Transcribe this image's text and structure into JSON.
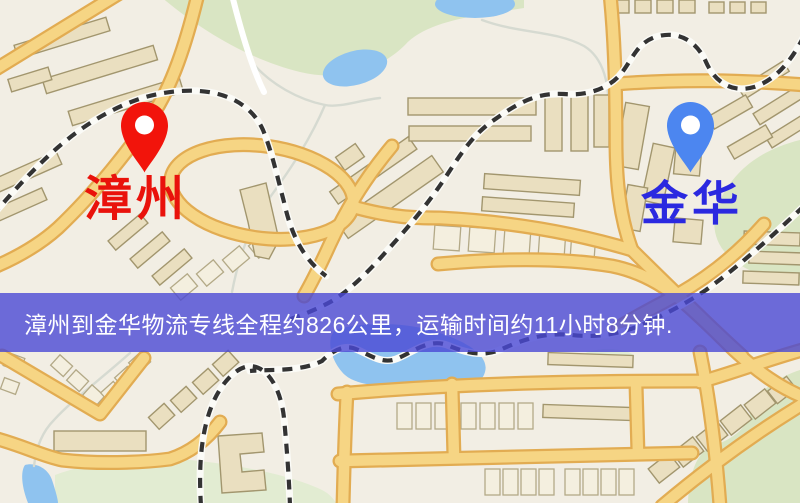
{
  "origin": {
    "name": "漳州",
    "pin_color": "#f2140b",
    "label_color": "#e9120b"
  },
  "destination": {
    "name": "金华",
    "pin_color": "#4c86f0",
    "label_color": "#2b29e0"
  },
  "banner": {
    "text": "漳州到金华物流专线全程约826公里，运输时间约11小时8分钟.",
    "background_color": "#4a49d5",
    "text_color": "#ffffff"
  },
  "route": {
    "origin": "漳州",
    "destination": "金华",
    "distance": "约826公里",
    "duration": "约11小时8分钟"
  }
}
